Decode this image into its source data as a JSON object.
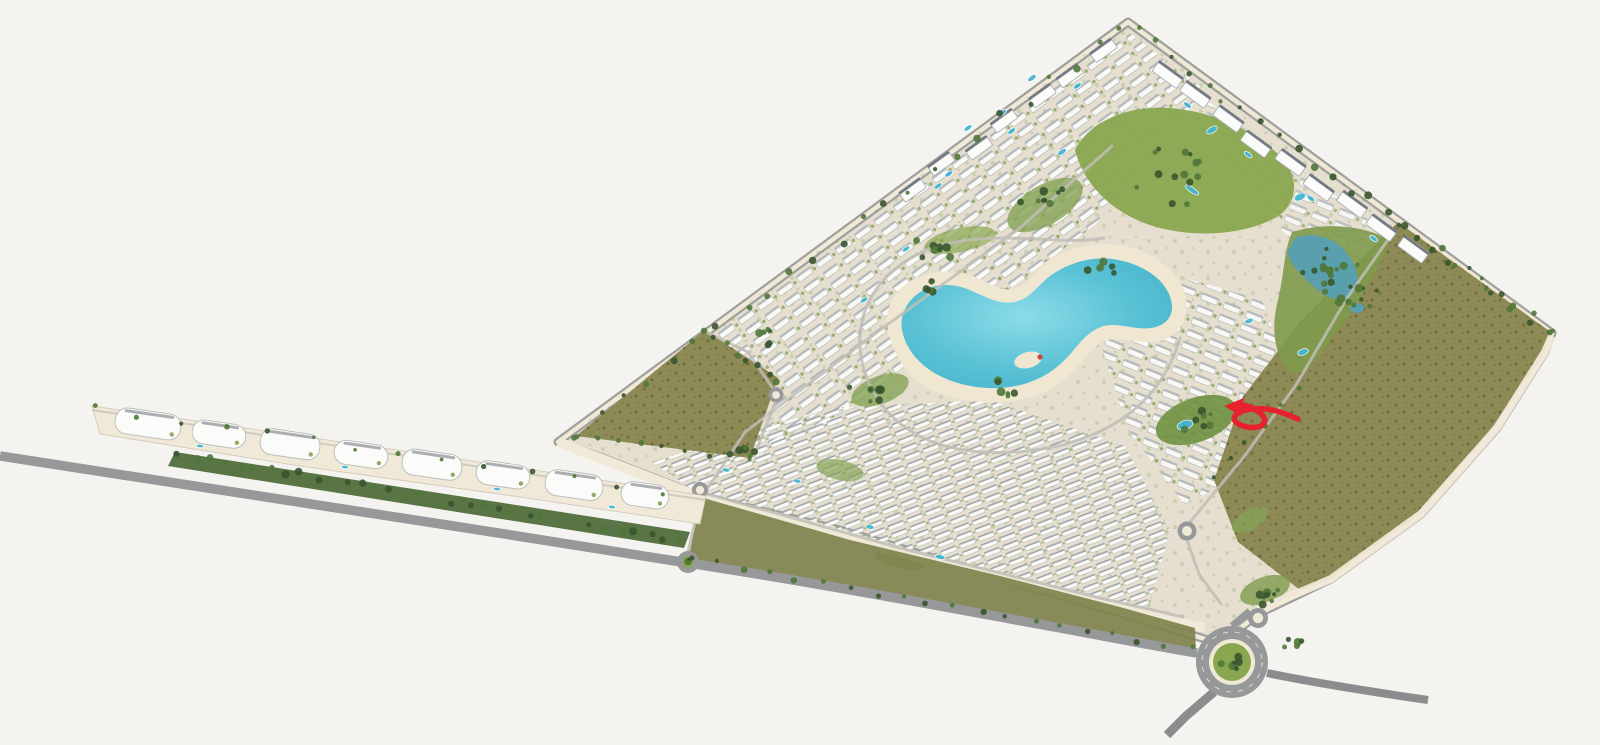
{
  "meta": {
    "title": "Residential community master plan - aerial 3D render",
    "view": "isometric aerial site plan",
    "visible_text": "none"
  },
  "palette": {
    "background": "#f5f3f0",
    "sand": "#e6dfd0",
    "sandLight": "#f1e9d8",
    "sandBeach": "#f0e7d2",
    "olive": "#8d8a56",
    "oliveDark": "#6d6b41",
    "oliveBand": "#7e824c",
    "lawn": "#8aa74f",
    "lawnDeep": "#6f9040",
    "treeDark": "#39552e",
    "treeMid": "#50773a",
    "water": "#5cc3d6",
    "pond": "#5a9fae",
    "road": "#97989a",
    "roadDark": "#8a8c8e",
    "internalRoad": "#c0beb6",
    "building": "#fbfbf9",
    "buildingShadow": "#aab0b3",
    "roofDark": "#4a525c",
    "poolCyan": "#45b6d2",
    "arrowRed": "#e8212f"
  },
  "features": {
    "site": "diamond-shaped gated community parcel",
    "lagoon": "central swimming lagoon",
    "beach": "lagoon sandy beach",
    "lagoonIsland": "beach islet in lagoon",
    "centralPark": "central landscaped park",
    "creekPark": "wooded creek park with ponds",
    "creekLake": "creek lake",
    "leftField": "undeveloped scrub parcel west",
    "rightField": "undeveloped scrub parcel east",
    "villaNW": "villa district along northwest edge",
    "villaEast": "villa district east of lagoon",
    "townhouses": "townhouse rows along south edge",
    "apartmentsNE": "apartment blocks along northeast edge",
    "apartmentsNW": "apartment blocks along northwest edge",
    "strip": "commercial strip parade",
    "stripGreen": "tree screen along strip",
    "perimeterRoad": "perimeter boulevard",
    "promenade": "boundary promenade",
    "oliveBand": "landscaped verge along south boundary",
    "mainRoundabout": "main entrance roundabout",
    "secondaryRoundabouts": "secondary roundabouts",
    "exitSE": "southeast exit road",
    "exitSW": "southwest exit road",
    "pools": "residential swimming pools",
    "trees": "tree planting",
    "arrow": "red marker arrow"
  },
  "annotation": {
    "kind": "hand-drawn looped arrow",
    "color": "#e8212f",
    "direction": "pointing left toward a poolside parcel east of the lagoon district"
  }
}
